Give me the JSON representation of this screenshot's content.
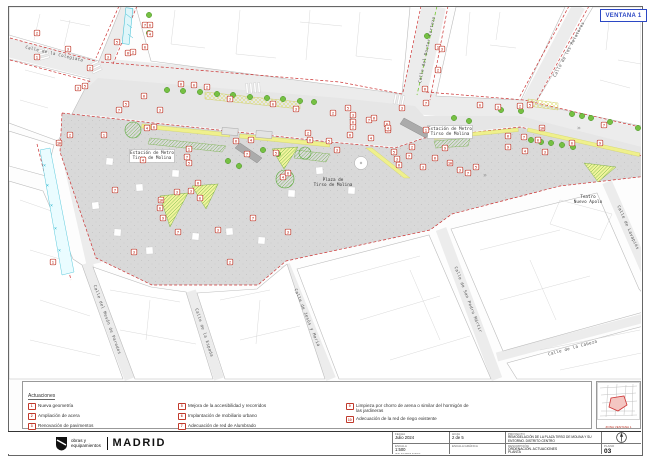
{
  "window": {
    "ventana_label": "VENTANA 1"
  },
  "colors": {
    "accent_red": "#c0392b",
    "ventana_blue": "#2b47c4",
    "tree_green": "#76c043",
    "planter_yellow": "#eff08c",
    "aqua": "#35bcd3",
    "plaza_gray": "#d9d9d9"
  },
  "map": {
    "street_labels": [
      {
        "text": "Calle de la Colegiata",
        "x": 54,
        "y": 55,
        "rot": 13
      },
      {
        "text": "Calle del Doctor Cortezo",
        "x": 428,
        "y": 50,
        "rot": -78
      },
      {
        "text": "Calle de los Relatores",
        "x": 570,
        "y": 50,
        "rot": -62
      },
      {
        "text": "Calle del Mesón de Paredes",
        "x": 106,
        "y": 320,
        "rot": 70
      },
      {
        "text": "Calle de la Espada",
        "x": 203,
        "y": 333,
        "rot": 72
      },
      {
        "text": "Calle de Jesús y María",
        "x": 306,
        "y": 318,
        "rot": 68
      },
      {
        "text": "Calle de San Pedro Mártir",
        "x": 467,
        "y": 300,
        "rot": 69
      },
      {
        "text": "Calle de la Cabeza",
        "x": 573,
        "y": 349,
        "rot": -15
      },
      {
        "text": "Calle de Lavapiés",
        "x": 627,
        "y": 228,
        "rot": 66
      }
    ],
    "place_labels": [
      {
        "lines": [
          "Estación de Metro",
          "Tirso de Molina"
        ],
        "x": 152,
        "y": 154,
        "box": true
      },
      {
        "lines": [
          "Estación de Metro",
          "Tirso de Molina"
        ],
        "x": 450,
        "y": 130,
        "box": true
      },
      {
        "lines": [
          "Plaza de",
          "Tirso de Molina"
        ],
        "x": 333,
        "y": 181,
        "box": false
      },
      {
        "lines": [
          "Teatro",
          "Nuevo Apolo"
        ],
        "x": 588,
        "y": 198,
        "box": false
      }
    ],
    "markers": [
      [
        37,
        33,
        "2"
      ],
      [
        37,
        57,
        "1"
      ],
      [
        68,
        49,
        "3"
      ],
      [
        78,
        88,
        "3"
      ],
      [
        85,
        86,
        "5"
      ],
      [
        90,
        68,
        "2"
      ],
      [
        108,
        57,
        "3"
      ],
      [
        117,
        42,
        "5"
      ],
      [
        128,
        53,
        "6"
      ],
      [
        133,
        52,
        "2"
      ],
      [
        145,
        25,
        "7"
      ],
      [
        150,
        25,
        "8"
      ],
      [
        150,
        34,
        "4"
      ],
      [
        145,
        47,
        "8"
      ],
      [
        59,
        143,
        "10"
      ],
      [
        70,
        135,
        "2"
      ],
      [
        104,
        135,
        "1"
      ],
      [
        119,
        110,
        "7"
      ],
      [
        126,
        104,
        "5"
      ],
      [
        144,
        96,
        "6"
      ],
      [
        147,
        128,
        "4"
      ],
      [
        154,
        127,
        "8"
      ],
      [
        160,
        110,
        "3"
      ],
      [
        181,
        84,
        "6"
      ],
      [
        194,
        85,
        "8"
      ],
      [
        207,
        87,
        "2"
      ],
      [
        230,
        99,
        "3"
      ],
      [
        236,
        141,
        "6"
      ],
      [
        247,
        154,
        "7"
      ],
      [
        251,
        140,
        "4"
      ],
      [
        273,
        104,
        "8"
      ],
      [
        276,
        153,
        "5"
      ],
      [
        283,
        177,
        "4"
      ],
      [
        296,
        109,
        "3"
      ],
      [
        308,
        133,
        "2"
      ],
      [
        310,
        140,
        "6"
      ],
      [
        115,
        190,
        "7"
      ],
      [
        143,
        160,
        "4"
      ],
      [
        161,
        200,
        "10"
      ],
      [
        160,
        208,
        "8"
      ],
      [
        163,
        218,
        "9"
      ],
      [
        177,
        192,
        "3"
      ],
      [
        189,
        149,
        "1"
      ],
      [
        187,
        157,
        "7"
      ],
      [
        189,
        163,
        "5"
      ],
      [
        191,
        191,
        "3"
      ],
      [
        198,
        183,
        "6"
      ],
      [
        200,
        198,
        "8"
      ],
      [
        218,
        230,
        "3"
      ],
      [
        253,
        218,
        "7"
      ],
      [
        288,
        173,
        "8"
      ],
      [
        329,
        141,
        "5"
      ],
      [
        337,
        150,
        "3"
      ],
      [
        350,
        135,
        "6"
      ],
      [
        353,
        127,
        "2"
      ],
      [
        369,
        120,
        "7"
      ],
      [
        371,
        138,
        "4"
      ],
      [
        387,
        124,
        "8"
      ],
      [
        388,
        130,
        "9"
      ],
      [
        394,
        152,
        "5"
      ],
      [
        397,
        159,
        "3"
      ],
      [
        399,
        165,
        "6"
      ],
      [
        409,
        156,
        "7"
      ],
      [
        412,
        147,
        "2"
      ],
      [
        423,
        167,
        "3"
      ],
      [
        426,
        130,
        "1"
      ],
      [
        435,
        158,
        "6"
      ],
      [
        445,
        148,
        "9"
      ],
      [
        450,
        163,
        "10"
      ],
      [
        460,
        170,
        "3"
      ],
      [
        468,
        173,
        "7"
      ],
      [
        476,
        167,
        "5"
      ],
      [
        438,
        47,
        "1"
      ],
      [
        442,
        49,
        "3"
      ],
      [
        438,
        70,
        "2"
      ],
      [
        425,
        89,
        "6"
      ],
      [
        402,
        108,
        "3"
      ],
      [
        426,
        103,
        "7"
      ],
      [
        348,
        108,
        "5"
      ],
      [
        353,
        115,
        "3"
      ],
      [
        353,
        122,
        "8"
      ],
      [
        374,
        118,
        "6"
      ],
      [
        388,
        128,
        "4"
      ],
      [
        333,
        113,
        "2"
      ],
      [
        480,
        105,
        "8"
      ],
      [
        498,
        107,
        "3"
      ],
      [
        508,
        136,
        "6"
      ],
      [
        508,
        147,
        "9"
      ],
      [
        520,
        106,
        "2"
      ],
      [
        524,
        137,
        "7"
      ],
      [
        525,
        151,
        "4"
      ],
      [
        530,
        105,
        "5"
      ],
      [
        538,
        140,
        "8"
      ],
      [
        542,
        128,
        "10"
      ],
      [
        545,
        152,
        "3"
      ],
      [
        572,
        143,
        "8"
      ],
      [
        600,
        143,
        "9"
      ],
      [
        604,
        125,
        "7"
      ],
      [
        53,
        262,
        "1"
      ],
      [
        134,
        252,
        "3"
      ],
      [
        178,
        232,
        "7"
      ],
      [
        230,
        262,
        "2"
      ],
      [
        288,
        232,
        "3"
      ]
    ],
    "trees": [
      [
        167,
        90
      ],
      [
        183,
        91
      ],
      [
        200,
        92
      ],
      [
        217,
        94
      ],
      [
        233,
        95
      ],
      [
        250,
        97
      ],
      [
        267,
        98
      ],
      [
        283,
        99
      ],
      [
        300,
        101
      ],
      [
        314,
        102
      ],
      [
        228,
        161
      ],
      [
        239,
        166
      ],
      [
        263,
        150
      ],
      [
        278,
        154
      ],
      [
        149,
        15
      ],
      [
        149,
        33
      ],
      [
        427,
        36
      ],
      [
        454,
        118
      ],
      [
        469,
        121
      ],
      [
        501,
        110
      ],
      [
        521,
        111
      ],
      [
        572,
        114
      ],
      [
        582,
        116
      ],
      [
        591,
        118
      ],
      [
        610,
        122
      ],
      [
        638,
        128
      ],
      [
        531,
        140
      ],
      [
        541,
        142
      ],
      [
        551,
        143
      ],
      [
        562,
        145
      ],
      [
        573,
        147
      ]
    ],
    "hatched_trees": [
      [
        133,
        130,
        8
      ],
      [
        285,
        179,
        9
      ],
      [
        305,
        153,
        6
      ]
    ]
  },
  "legend": {
    "title": "Actuaciones",
    "items": [
      {
        "n": "1",
        "text": "Nueva geometría",
        "col": 1
      },
      {
        "n": "2",
        "text": "Ampliación de acera",
        "col": 1
      },
      {
        "n": "3",
        "text": "Renovación de pavimentos",
        "col": 1
      },
      {
        "n": "4",
        "text": "Nuevos parterres y ampliación y mejora de alcorques existentes",
        "col": 1
      },
      {
        "n": "5",
        "text": "Mejora de la accesibilidad y recorridos",
        "col": 2
      },
      {
        "n": "6",
        "text": "Implantación de mobiliario urbano",
        "col": 2
      },
      {
        "n": "7",
        "text": "Adecuación de red de Alumbrado",
        "col": 2
      },
      {
        "n": "8",
        "text": "Plantación de nuevo arbolado",
        "col": 2
      },
      {
        "n": "9",
        "text": "Limpieza por chorro de arena o similar del hormigón de las jardineras",
        "col": 3
      },
      {
        "n": "10",
        "text": "Adecuación de la red de riego existente",
        "col": 3
      }
    ]
  },
  "keymap": {
    "caption": "ZONA VENTANA 1"
  },
  "titleblock": {
    "logo_line1": "obras y",
    "logo_line2": "equipamientos",
    "logo_city": "MADRID",
    "fecha_label": "Fecha",
    "fecha": "Julio 2024",
    "hoja_label": "Hoja",
    "hoja": "2 de 5",
    "escala_label": "Escala",
    "escala": "1:500",
    "escala_nota": "(EN A3 REDUCIDO)",
    "grafica_label": "Escala Gráfica",
    "grafica_unit": "m",
    "proyecto_label": "Proyecto",
    "proyecto": "REMODELACIÓN DE LA PLAZA TIRSO DE MOLINA Y SU ENTORNO. DISTRITO CENTRO",
    "descripcion_label": "Descripción",
    "descripcion1": "ORDENACIÓN. ACTUACIONES",
    "descripcion2": "PLANTA",
    "plano_label": "Plano",
    "plano": "03"
  }
}
